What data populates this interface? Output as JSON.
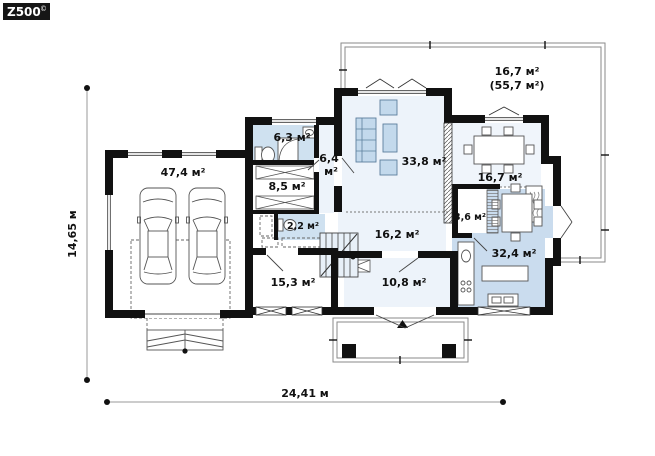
{
  "logo": {
    "text": "Z500",
    "copyright": "©"
  },
  "dimensions": {
    "width": "24,41 м",
    "height": "14,65 м"
  },
  "rooms": {
    "garage": "47,4 м²",
    "bathroom": "6,3 м²",
    "corridor_line1": "6,4",
    "corridor_line2": "м²",
    "wardrobe": "8,5 м²",
    "wc": "2,2 м²",
    "hall": "16,2 м²",
    "room_left": "15,3 м²",
    "room_bottom": "10,8 м²",
    "living_room": "33,8 м²",
    "dining_room": "16,7 м²",
    "pantry": "3,6 м²",
    "kitchen": "32,4 м²"
  },
  "terrace": {
    "line1": "16,7 м²",
    "line2": "(55,7 м²)"
  },
  "colors": {
    "wall": "#111111",
    "room_light": "#edf3fa",
    "room_blue": "#cadcee",
    "furniture_blue": "#c3d9ec"
  }
}
